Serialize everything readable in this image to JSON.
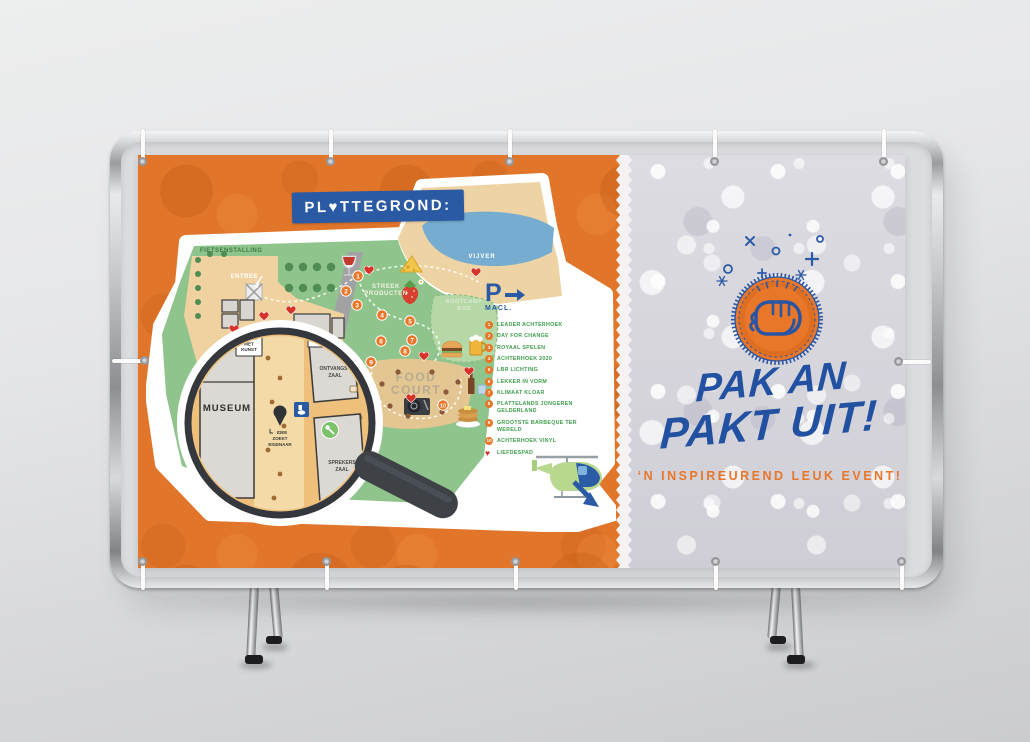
{
  "banner": {
    "map_side": {
      "title": "PL♥TTEGROND:",
      "labels": {
        "fietsenstalling": "FIETSENSTALLING",
        "entree": "ENTREE",
        "vijver": "VIJVER",
        "streek": [
          "STREEK",
          "PRODUCTEN"
        ],
        "bootcamp": [
          "BOOTCAMP",
          "BOS"
        ],
        "food_court": [
          "FOOD",
          "COURT"
        ]
      },
      "magnifier": {
        "museum": "MUSEUM",
        "daten": [
          "DATEN",
          "MET",
          "KUNST"
        ],
        "ontvangst": [
          "ONTVANGST",
          "ZAAL"
        ],
        "sprekers": [
          "SPREKERS",
          "ZAAL"
        ],
        "idee": [
          "IDEE",
          "ZOEKT",
          "EIGENAAR"
        ]
      },
      "parking": {
        "symbol": "P",
        "label": "MACL."
      },
      "markers": [
        "1",
        "2",
        "3",
        "4",
        "5",
        "6",
        "7",
        "8",
        "9",
        "10"
      ],
      "legend": [
        {
          "n": "1",
          "label": "LEADER ACHTERHOEK"
        },
        {
          "n": "2",
          "label": "DAY FOR CHANGE"
        },
        {
          "n": "3",
          "label": "ROYAAL SPELEN"
        },
        {
          "n": "4",
          "label": "ACHTERHOEK 2020"
        },
        {
          "n": "5",
          "label": "LBR LICHTING"
        },
        {
          "n": "6",
          "label": "LEKKER IN VORM"
        },
        {
          "n": "7",
          "label": "KLIMAAT KLOAR"
        },
        {
          "n": "8",
          "label": "PLATTELANDS JONGEREN GELDERLAND"
        },
        {
          "n": "9",
          "label": "GROOTSTE BARBEQUE TER WERELD"
        },
        {
          "n": "10",
          "label": "ACHTERHOEK VINYL"
        },
        {
          "n": "♥",
          "label": "LIEFDESPAD"
        }
      ]
    },
    "promo_side": {
      "heading_line1": "PAK AN",
      "heading_line2": "PAKT UIT!",
      "subheading": "‘N INSPIREUREND LEUK EVENT!"
    },
    "colors": {
      "orange": "#e1762b",
      "blue": "#2b5aa5",
      "heading_blue": "#2251a1",
      "legend_green": "#3f9d4b",
      "heart_red": "#d6332a",
      "silver": "#d9d8de",
      "map_green": "#8fc48c",
      "magnifier_tan": "#eec07c"
    }
  }
}
